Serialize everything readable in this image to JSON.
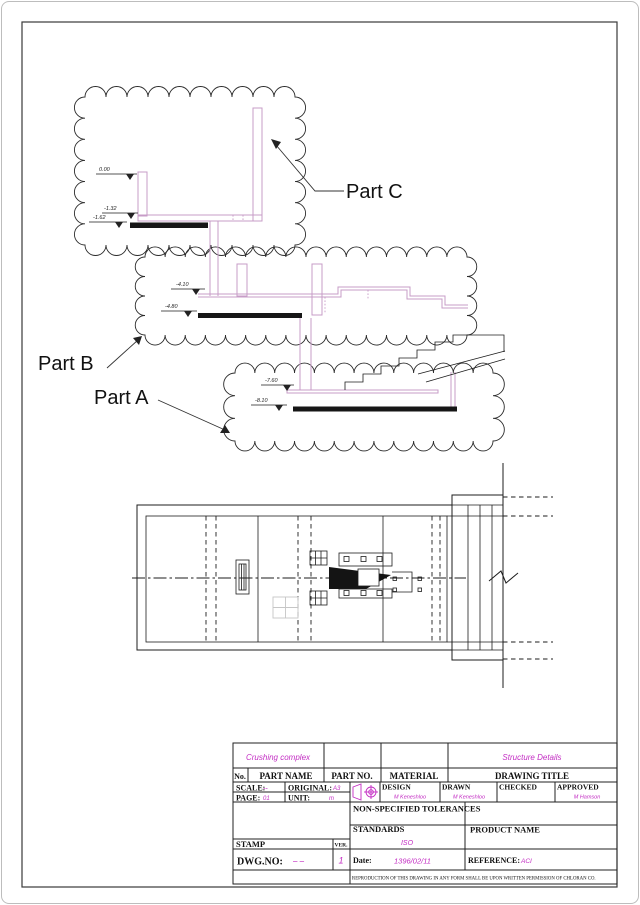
{
  "colors": {
    "magenta": "#c32cc3",
    "wall_pink": "#c79cc7",
    "ink": "#1d1d1d"
  },
  "drawing": {
    "labels": {
      "part_a": "Part A",
      "part_b": "Part B",
      "part_c": "Part C"
    },
    "elev": {
      "e000": "0.00",
      "e132": "-1.32",
      "e162": "-1.62",
      "e410": "-4.10",
      "e480": "-4.80",
      "e760": "-7.60",
      "e810": "-8.10"
    }
  },
  "tb": {
    "project": "Crushing complex",
    "title_value": "Structure Details",
    "col_no": "No.",
    "col_part_name": "PART NAME",
    "col_part_no": "PART NO.",
    "col_material": "MATERIAL",
    "col_drawing_title": "DRAWING TITLE",
    "scale_label": "SCALE:",
    "scale_value": "--",
    "original_label": "ORIGINAL:",
    "original_value": "A3",
    "page_label": "PAGE:",
    "page_value": "01",
    "unit_label": "UNIT:",
    "unit_value": "m",
    "design_label": "DESIGN",
    "design_value": "M Keneshloo",
    "drawn_label": "DRAWN",
    "drawn_value": "M Keneshloo",
    "checked_label": "CHECKED",
    "checked_value": "",
    "approved_label": "APPROVED",
    "approved_value": "M Hamson",
    "tolerances_label": "NON-SPECIFIED  TOLERANCES",
    "standards_label": "STANDARDS",
    "standards_value": "ISO",
    "product_label": "PRODUCT NAME",
    "stamp_label": "STAMP",
    "ver_label": "VER.",
    "ver_value": "1",
    "dwg_label": "DWG.NO:",
    "dwg_value": "– –",
    "date_label": "Date:",
    "date_value": "1396/02/11",
    "ref_label": "REFERENCE:",
    "ref_value": "ACI",
    "note": "REPRODUCTION OF THIS DRAWING IN ANY FORM SHALL BE UPON WRITTEN PERMISSION OF CHLORAN CO."
  }
}
